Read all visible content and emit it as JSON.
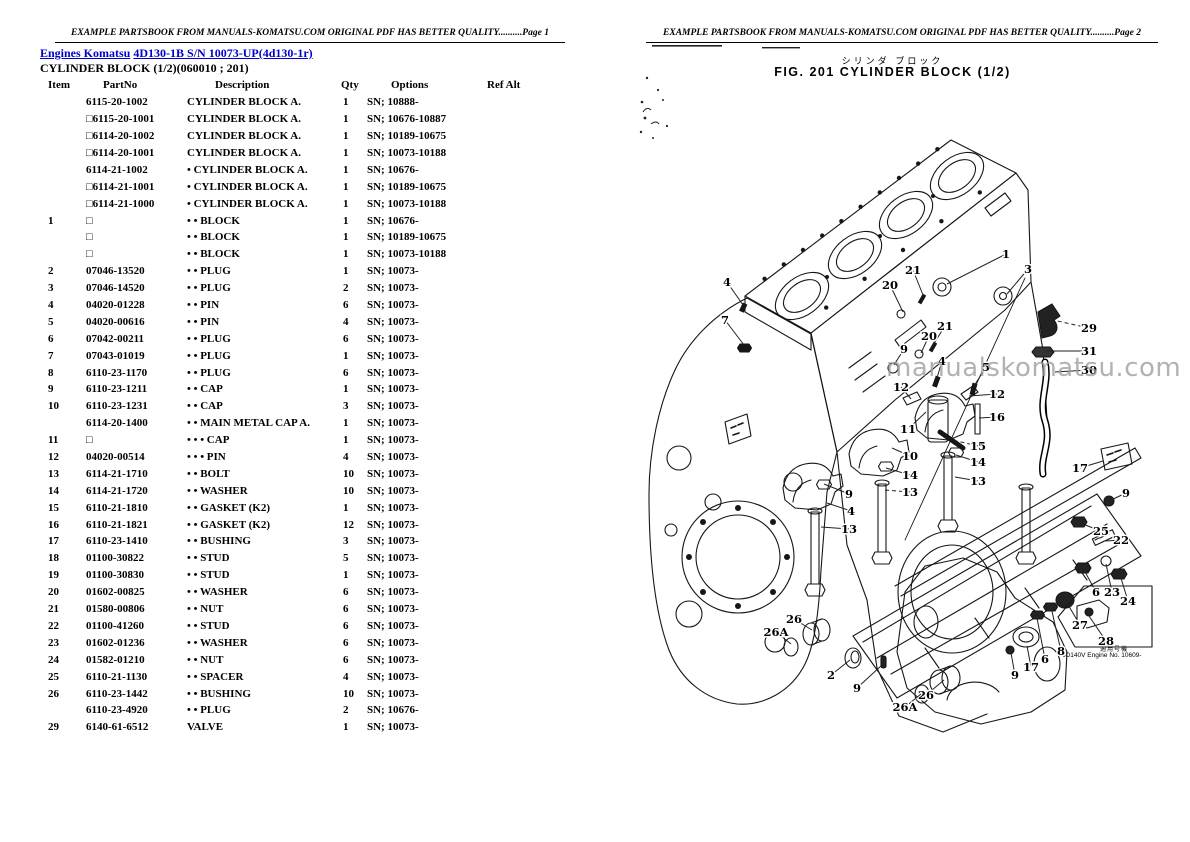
{
  "header": {
    "banner_text": "EXAMPLE PARTSBOOK FROM MANUALS-KOMATSU.COM ORIGINAL PDF HAS BETTER QUALITY..........",
    "page_left": "Page 1",
    "page_right": "Page 2"
  },
  "left_page": {
    "link_engines": "Engines Komatsu",
    "link_model": "4D130-1B S/N 10073-UP(4d130-1r)",
    "subtitle": "CYLINDER BLOCK (1/2)(060010 ; 201)",
    "table": {
      "columns": [
        "Item",
        "PartNo",
        "Description",
        "Qty",
        "Options",
        "Ref Alt"
      ],
      "rows": [
        {
          "item": "",
          "partno": "6115-20-1002",
          "desc": "CYLINDER BLOCK A.",
          "qty": "1",
          "options": "SN; 10888-",
          "ref": ""
        },
        {
          "item": "",
          "partno": "□6115-20-1001",
          "desc": "CYLINDER BLOCK A.",
          "qty": "1",
          "options": "SN; 10676-10887",
          "ref": ""
        },
        {
          "item": "",
          "partno": "□6114-20-1002",
          "desc": "CYLINDER BLOCK A.",
          "qty": "1",
          "options": "SN; 10189-10675",
          "ref": ""
        },
        {
          "item": "",
          "partno": "□6114-20-1001",
          "desc": "CYLINDER BLOCK A.",
          "qty": "1",
          "options": "SN; 10073-10188",
          "ref": ""
        },
        {
          "item": "",
          "partno": "6114-21-1002",
          "desc": "• CYLINDER BLOCK A.",
          "qty": "1",
          "options": "SN; 10676-",
          "ref": ""
        },
        {
          "item": "",
          "partno": "□6114-21-1001",
          "desc": "• CYLINDER BLOCK A.",
          "qty": "1",
          "options": "SN; 10189-10675",
          "ref": ""
        },
        {
          "item": "",
          "partno": "□6114-21-1000",
          "desc": "• CYLINDER BLOCK A.",
          "qty": "1",
          "options": "SN; 10073-10188",
          "ref": ""
        },
        {
          "item": "1",
          "partno": "□",
          "desc": "• • BLOCK",
          "qty": "1",
          "options": "SN; 10676-",
          "ref": ""
        },
        {
          "item": "",
          "partno": "□",
          "desc": "• • BLOCK",
          "qty": "1",
          "options": "SN; 10189-10675",
          "ref": ""
        },
        {
          "item": "",
          "partno": "□",
          "desc": "• • BLOCK",
          "qty": "1",
          "options": "SN; 10073-10188",
          "ref": ""
        },
        {
          "item": "2",
          "partno": "07046-13520",
          "desc": "• • PLUG",
          "qty": "1",
          "options": "SN; 10073-",
          "ref": ""
        },
        {
          "item": "3",
          "partno": "07046-14520",
          "desc": "• • PLUG",
          "qty": "2",
          "options": "SN; 10073-",
          "ref": ""
        },
        {
          "item": "4",
          "partno": "04020-01228",
          "desc": "• • PIN",
          "qty": "6",
          "options": "SN; 10073-",
          "ref": ""
        },
        {
          "item": "5",
          "partno": "04020-00616",
          "desc": "• • PIN",
          "qty": "4",
          "options": "SN; 10073-",
          "ref": ""
        },
        {
          "item": "6",
          "partno": "07042-00211",
          "desc": "• • PLUG",
          "qty": "6",
          "options": "SN; 10073-",
          "ref": ""
        },
        {
          "item": "7",
          "partno": "07043-01019",
          "desc": "• • PLUG",
          "qty": "1",
          "options": "SN; 10073-",
          "ref": ""
        },
        {
          "item": "8",
          "partno": "6110-23-1170",
          "desc": "• • PLUG",
          "qty": "6",
          "options": "SN; 10073-",
          "ref": ""
        },
        {
          "item": "9",
          "partno": "6110-23-1211",
          "desc": "• • CAP",
          "qty": "1",
          "options": "SN; 10073-",
          "ref": ""
        },
        {
          "item": "10",
          "partno": "6110-23-1231",
          "desc": "• • CAP",
          "qty": "3",
          "options": "SN; 10073-",
          "ref": ""
        },
        {
          "item": "",
          "partno": "6114-20-1400",
          "desc": "• • MAIN METAL CAP A.",
          "qty": "1",
          "options": "SN; 10073-",
          "ref": ""
        },
        {
          "item": "11",
          "partno": "□",
          "desc": "• • • CAP",
          "qty": "1",
          "options": "SN; 10073-",
          "ref": ""
        },
        {
          "item": "12",
          "partno": "04020-00514",
          "desc": "• • • PIN",
          "qty": "4",
          "options": "SN; 10073-",
          "ref": ""
        },
        {
          "item": "13",
          "partno": "6114-21-1710",
          "desc": "• • BOLT",
          "qty": "10",
          "options": "SN; 10073-",
          "ref": ""
        },
        {
          "item": "14",
          "partno": "6114-21-1720",
          "desc": "• • WASHER",
          "qty": "10",
          "options": "SN; 10073-",
          "ref": ""
        },
        {
          "item": "15",
          "partno": "6110-21-1810",
          "desc": "• • GASKET (K2)",
          "qty": "1",
          "options": "SN; 10073-",
          "ref": ""
        },
        {
          "item": "16",
          "partno": "6110-21-1821",
          "desc": "• • GASKET (K2)",
          "qty": "12",
          "options": "SN; 10073-",
          "ref": ""
        },
        {
          "item": "17",
          "partno": "6110-23-1410",
          "desc": "• • BUSHING",
          "qty": "3",
          "options": "SN; 10073-",
          "ref": ""
        },
        {
          "item": "18",
          "partno": "01100-30822",
          "desc": "• • STUD",
          "qty": "5",
          "options": "SN; 10073-",
          "ref": ""
        },
        {
          "item": "19",
          "partno": "01100-30830",
          "desc": "• • STUD",
          "qty": "1",
          "options": "SN; 10073-",
          "ref": ""
        },
        {
          "item": "20",
          "partno": "01602-00825",
          "desc": "• • WASHER",
          "qty": "6",
          "options": "SN; 10073-",
          "ref": ""
        },
        {
          "item": "21",
          "partno": "01580-00806",
          "desc": "• • NUT",
          "qty": "6",
          "options": "SN; 10073-",
          "ref": ""
        },
        {
          "item": "22",
          "partno": "01100-41260",
          "desc": "• • STUD",
          "qty": "6",
          "options": "SN; 10073-",
          "ref": ""
        },
        {
          "item": "23",
          "partno": "01602-01236",
          "desc": "• • WASHER",
          "qty": "6",
          "options": "SN; 10073-",
          "ref": ""
        },
        {
          "item": "24",
          "partno": "01582-01210",
          "desc": "• • NUT",
          "qty": "6",
          "options": "SN; 10073-",
          "ref": ""
        },
        {
          "item": "25",
          "partno": "6110-21-1130",
          "desc": "• • SPACER",
          "qty": "4",
          "options": "SN; 10073-",
          "ref": ""
        },
        {
          "item": "26",
          "partno": "6110-23-1442",
          "desc": "• • BUSHING",
          "qty": "10",
          "options": "SN; 10073-",
          "ref": ""
        },
        {
          "item": "",
          "partno": "6110-23-4920",
          "desc": "• • PLUG",
          "qty": "2",
          "options": "SN; 10676-",
          "ref": ""
        },
        {
          "item": "29",
          "partno": "6140-61-6512",
          "desc": "VALVE",
          "qty": "1",
          "options": "SN; 10073-",
          "ref": ""
        }
      ]
    }
  },
  "right_page": {
    "title_jp": "シリンダ ブロック",
    "title": "FIG. 201  CYLINDER BLOCK  (1/2)",
    "watermark": "manualskomatsu.com",
    "applicability_jp": "適用号機",
    "applicability": "6D140V Engine No. 10609-",
    "callouts": [
      {
        "n": "1",
        "x": 411,
        "y": 254,
        "tx": 352,
        "ty": 284
      },
      {
        "n": "3",
        "x": 433,
        "y": 269,
        "tx": 412,
        "ty": 294
      },
      {
        "n": "29",
        "x": 494,
        "y": 328,
        "tx": 458,
        "ty": 320,
        "dash": true
      },
      {
        "n": "31",
        "x": 494,
        "y": 351,
        "tx": 452,
        "ty": 351
      },
      {
        "n": "30",
        "x": 494,
        "y": 370,
        "tx": 460,
        "ty": 372
      },
      {
        "n": "21",
        "x": 318,
        "y": 270,
        "tx": 328,
        "ty": 295
      },
      {
        "n": "20",
        "x": 295,
        "y": 285,
        "tx": 308,
        "ty": 312
      },
      {
        "n": "21",
        "x": 350,
        "y": 326,
        "tx": 338,
        "ty": 345
      },
      {
        "n": "20",
        "x": 334,
        "y": 336,
        "tx": 326,
        "ty": 353
      },
      {
        "n": "9",
        "x": 309,
        "y": 349,
        "tx": 299,
        "ty": 365
      },
      {
        "n": "5",
        "x": 391,
        "y": 367,
        "tx": 379,
        "ty": 386
      },
      {
        "n": "4",
        "x": 347,
        "y": 361,
        "tx": 342,
        "ty": 378
      },
      {
        "n": "12",
        "x": 306,
        "y": 387,
        "tx": 316,
        "ty": 399
      },
      {
        "n": "12",
        "x": 402,
        "y": 394,
        "tx": 374,
        "ty": 396
      },
      {
        "n": "16",
        "x": 402,
        "y": 417,
        "tx": 384,
        "ty": 418
      },
      {
        "n": "11",
        "x": 313,
        "y": 429,
        "tx": 331,
        "ty": 412
      },
      {
        "n": "15",
        "x": 383,
        "y": 446,
        "tx": 362,
        "ty": 441,
        "dash": true
      },
      {
        "n": "14",
        "x": 383,
        "y": 462,
        "tx": 361,
        "ty": 455
      },
      {
        "n": "13",
        "x": 383,
        "y": 481,
        "tx": 360,
        "ty": 477
      },
      {
        "n": "10",
        "x": 315,
        "y": 456,
        "tx": 297,
        "ty": 448
      },
      {
        "n": "14",
        "x": 315,
        "y": 475,
        "tx": 291,
        "ty": 468
      },
      {
        "n": "13",
        "x": 315,
        "y": 492,
        "tx": 290,
        "ty": 490,
        "dash": true
      },
      {
        "n": "9",
        "x": 254,
        "y": 494,
        "tx": 229,
        "ty": 484
      },
      {
        "n": "4",
        "x": 256,
        "y": 511,
        "tx": 232,
        "ty": 503
      },
      {
        "n": "13",
        "x": 254,
        "y": 529,
        "tx": 226,
        "ty": 527
      },
      {
        "n": "4",
        "x": 132,
        "y": 282,
        "tx": 148,
        "ty": 305
      },
      {
        "n": "7",
        "x": 130,
        "y": 320,
        "tx": 149,
        "ty": 345
      },
      {
        "n": "17",
        "x": 485,
        "y": 468,
        "tx": 508,
        "ty": 461
      },
      {
        "n": "26",
        "x": 199,
        "y": 619,
        "tx": 217,
        "ty": 630
      },
      {
        "n": "26A",
        "x": 181,
        "y": 632,
        "tx": 196,
        "ty": 644
      },
      {
        "n": "2",
        "x": 236,
        "y": 675,
        "tx": 255,
        "ty": 660
      },
      {
        "n": "9",
        "x": 262,
        "y": 688,
        "tx": 287,
        "ty": 665
      },
      {
        "n": "26",
        "x": 331,
        "y": 695,
        "tx": 349,
        "ty": 680
      },
      {
        "n": "26A",
        "x": 310,
        "y": 707,
        "tx": 326,
        "ty": 694
      },
      {
        "n": "9",
        "x": 531,
        "y": 493,
        "tx": 514,
        "ty": 501
      },
      {
        "n": "25",
        "x": 506,
        "y": 531,
        "tx": 485,
        "ty": 523
      },
      {
        "n": "22",
        "x": 526,
        "y": 540,
        "tx": 511,
        "ty": 541
      },
      {
        "n": "6",
        "x": 501,
        "y": 592,
        "tx": 489,
        "ty": 570
      },
      {
        "n": "23",
        "x": 517,
        "y": 592,
        "tx": 511,
        "ty": 564
      },
      {
        "n": "24",
        "x": 533,
        "y": 601,
        "tx": 525,
        "ty": 575
      },
      {
        "n": "27",
        "x": 485,
        "y": 625,
        "tx": 472,
        "ty": 603
      },
      {
        "n": "28",
        "x": 511,
        "y": 641,
        "tx": 494,
        "ty": 616
      },
      {
        "n": "8",
        "x": 466,
        "y": 651,
        "tx": 456,
        "ty": 607
      },
      {
        "n": "6",
        "x": 450,
        "y": 659,
        "tx": 442,
        "ty": 618
      },
      {
        "n": "17",
        "x": 436,
        "y": 667,
        "tx": 432,
        "ty": 646
      },
      {
        "n": "9",
        "x": 420,
        "y": 675,
        "tx": 416,
        "ty": 653
      }
    ]
  }
}
